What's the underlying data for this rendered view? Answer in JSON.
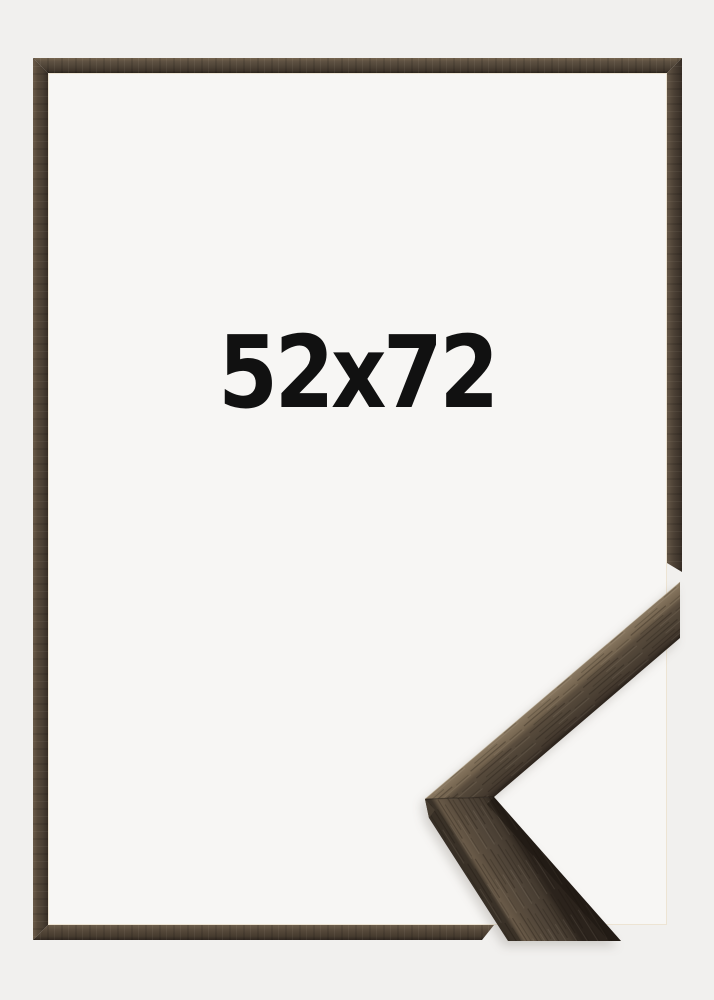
{
  "product": {
    "size_label": "52x72"
  },
  "icons": {
    "corner_detail": "frame-corner-profile-chevron"
  },
  "colors": {
    "page_background": "#f1f0ee",
    "frame_interior": "#f7f6f4",
    "wood_highlight": "#867560",
    "wood_mid": "#4f4437",
    "wood_dark_edge": "#2a231d",
    "label_text": "#111111"
  }
}
